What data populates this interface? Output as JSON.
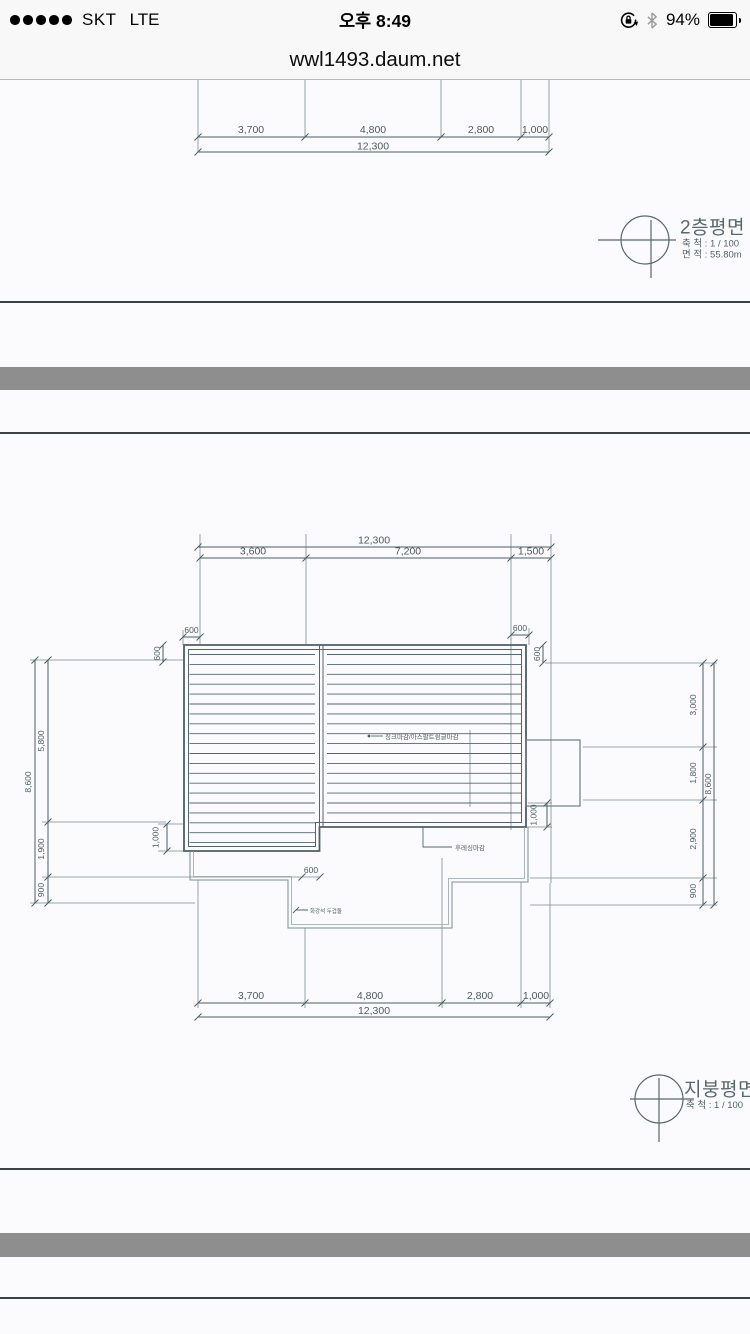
{
  "status_bar": {
    "carrier": "SKT",
    "network": "LTE",
    "time": "오후 8:49",
    "battery": "94%"
  },
  "browser": {
    "url": "wwl1493.daum.net"
  },
  "floor_plan_page": {
    "title": "2층평면",
    "scale": "축  척 : 1 / 100",
    "area": "면  적 : 55.80m",
    "dims": {
      "segments": [
        "3,700",
        "4,800",
        "2,800",
        "1,000"
      ],
      "total": "12,300"
    }
  },
  "roof_plan_page": {
    "title": "지붕평면",
    "scale": "축  척 : 1 / 100",
    "dims_top": {
      "total": "12,300",
      "segments": [
        "3,600",
        "7,200",
        "1,500"
      ]
    },
    "dims_bottom": {
      "segments": [
        "3,700",
        "4,800",
        "2,800",
        "1,000"
      ],
      "total": "12,300"
    },
    "dims_left": {
      "segments": [
        "5,800",
        "1,900",
        "900"
      ],
      "total": "8,600",
      "overhang": "1,000",
      "eave_h": "600",
      "eave_v": "600"
    },
    "dims_right": {
      "segments": [
        "3,000",
        "1,800",
        "2,900",
        "900"
      ],
      "total": "8,600",
      "overhang": "1,000",
      "eave_h": "600",
      "eave_v": "600"
    },
    "dim_step": "600",
    "annotations": {
      "roof_finish": "징크마감/아스팔트슁글마감",
      "flashing": "후레싱마감",
      "coping": "화강석 두겁돌"
    }
  }
}
